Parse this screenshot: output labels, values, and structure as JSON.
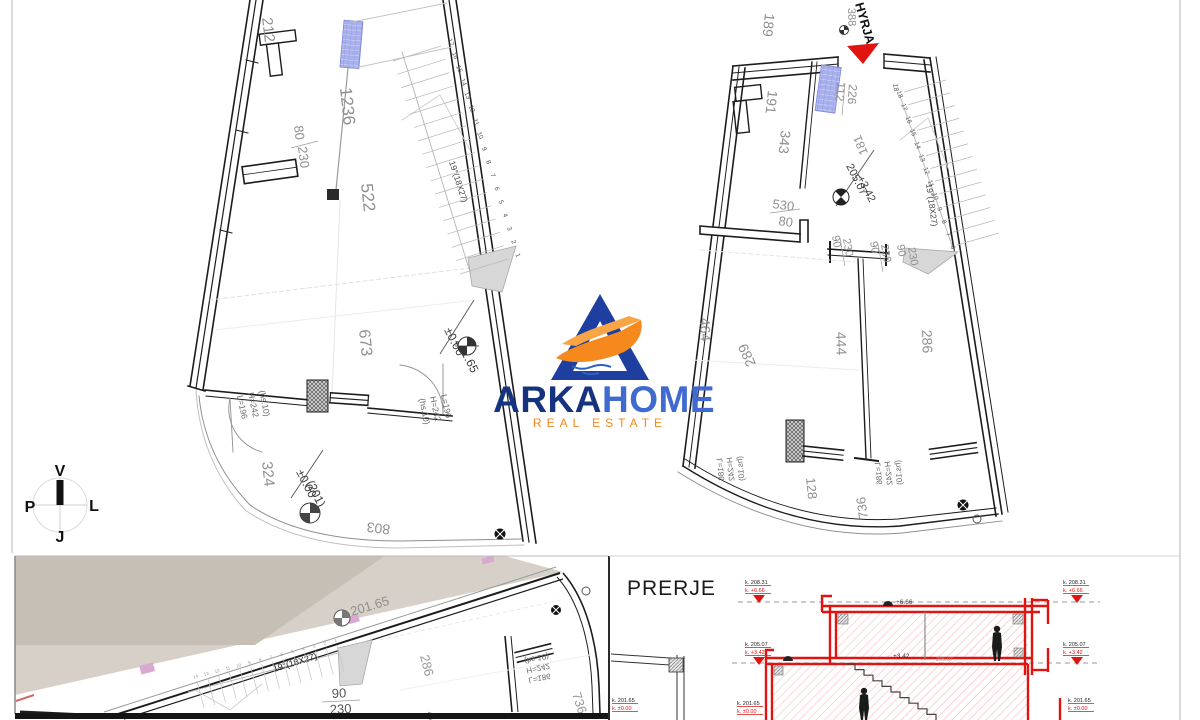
{
  "logo": {
    "name": "ARKA",
    "name2": "HOME",
    "tagline": "REAL ESTATE"
  },
  "compass": {
    "north": "V",
    "east": "L",
    "south": "J",
    "west": "P"
  },
  "plan_tl": {
    "dims": {
      "d212": "212",
      "d80": "80",
      "d230": "230",
      "d1236": "1236",
      "d522": "522",
      "d673": "673",
      "d324": "324",
      "d803": "803"
    },
    "levels": {
      "a1": "±0.00",
      "a2": "201.65",
      "b1": "±0.00",
      "b2": "(201)"
    },
    "door_label": {
      "l1": "L=196",
      "l2": "H=242",
      "l3": "(hs.10)"
    },
    "stair_label": "19°(18X27)",
    "steps": [
      "17",
      "16",
      "15",
      "14",
      "13",
      "12",
      "11",
      "10",
      "9",
      "8",
      "7",
      "6",
      "5",
      "4",
      "3",
      "2",
      "1"
    ]
  },
  "plan_tr": {
    "entrance": "HYRJA",
    "dims": {
      "d388": "388",
      "d189": "189",
      "d112": "112",
      "d226": "226",
      "d191": "191",
      "d343": "343",
      "d181": "181",
      "d530": "530",
      "d80": "80",
      "d90": "90",
      "d230": "230",
      "d464": "464",
      "d289": "289",
      "d444": "444",
      "d286": "286",
      "d128": "128",
      "d736": "736",
      "d18": "18"
    },
    "level": {
      "l1": "205.07",
      "l2": "+3.42"
    },
    "door_label": {
      "l1": "L=186",
      "l2": "H=242",
      "l3": "(hs.10)"
    },
    "stair_label": "19°(18X27)",
    "steps": [
      "18",
      "17",
      "16",
      "15",
      "14",
      "13",
      "12",
      "11",
      "10",
      "9",
      "8",
      "7",
      "6"
    ]
  },
  "plan_bl": {
    "level": "201.65",
    "stair_label": "19°(18X27)",
    "dims": {
      "d90": "90",
      "d230": "230",
      "d286": "286",
      "d444": "444",
      "d736": "736"
    },
    "door_label": {
      "l1": "L=186",
      "l2": "H=242",
      "l3": "(hs.10)"
    },
    "steps": [
      "14",
      "13",
      "12",
      "11",
      "10",
      "9",
      "8",
      "7",
      "6",
      "5",
      "4",
      "3",
      "2",
      "1"
    ]
  },
  "section": {
    "title": "PRERJE",
    "levels": {
      "top": {
        "elev": "k. 208.31",
        "rel": "k. +6.66"
      },
      "mid": {
        "elev": "k. 205.07",
        "rel": "k. +3.42"
      },
      "bot": {
        "elev": "k. 201.65",
        "rel": "k. ±0.00"
      }
    },
    "annotations": {
      "top": "+6.66",
      "mid": "+3.42",
      "mid2": "205.07"
    }
  },
  "colors": {
    "red": "#e01511",
    "blue_dark": "#16337f",
    "blue": "#3f6ad0",
    "orange": "#f5891e",
    "window": "#a9b0ea",
    "dim": "#8f8f8f"
  }
}
